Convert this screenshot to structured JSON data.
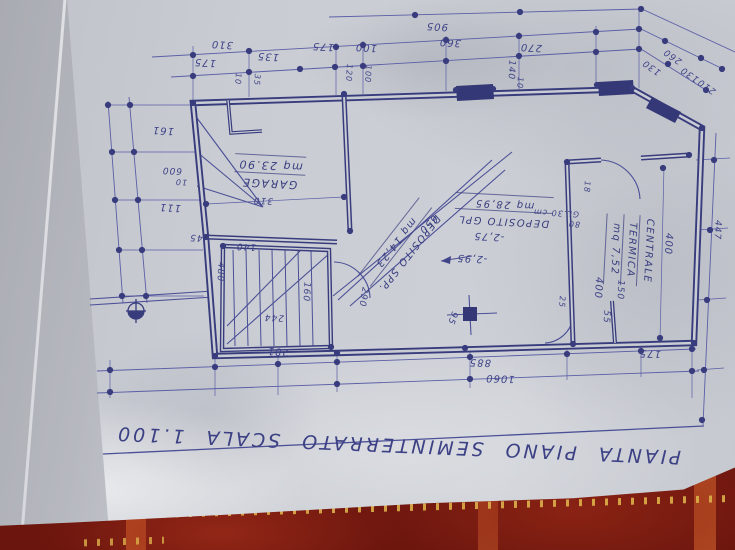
{
  "plan": {
    "title": "PIANTA PIANO SEMINTERRATO SCALA 1.100",
    "rooms": [
      {
        "lines": [
          "GARAGE",
          "mq 23.90"
        ],
        "x": 270,
        "y": 173,
        "r": 183,
        "s": 11
      },
      {
        "lines": [
          "DEPOSITO SPP.",
          "mq 14,23"
        ],
        "x": 401,
        "y": 247,
        "r": 128,
        "s": 10
      },
      {
        "lines": [
          "DEPOSITO GPL",
          "mq 28,95"
        ],
        "x": 504,
        "y": 211,
        "r": 183,
        "s": 10
      },
      {
        "lines": [
          "CENTRALE",
          "TERMICA",
          "mq 7,52"
        ],
        "x": 630,
        "y": 250,
        "r": 93,
        "s": 10
      }
    ],
    "annotations": [
      {
        "t": "905",
        "x": 437,
        "y": 26,
        "r": 183
      },
      {
        "t": "310",
        "x": 222,
        "y": 44,
        "r": 183
      },
      {
        "t": "175",
        "x": 205,
        "y": 62,
        "r": 183
      },
      {
        "t": "135",
        "x": 268,
        "y": 56,
        "r": 183
      },
      {
        "t": "175",
        "x": 323,
        "y": 46,
        "r": 183
      },
      {
        "t": "100",
        "x": 366,
        "y": 47,
        "r": 183
      },
      {
        "t": "360",
        "x": 450,
        "y": 42,
        "r": 183
      },
      {
        "t": "270",
        "x": 531,
        "y": 47,
        "r": 183
      },
      {
        "t": "140",
        "x": 511,
        "y": 70,
        "r": 93,
        "s": 9
      },
      {
        "t": "10",
        "x": 520,
        "y": 83,
        "r": 93,
        "s": 8
      },
      {
        "t": "10",
        "x": 238,
        "y": 79,
        "r": 93,
        "s": 8
      },
      {
        "t": "35",
        "x": 257,
        "y": 80,
        "r": 93,
        "s": 8
      },
      {
        "t": "120",
        "x": 349,
        "y": 73,
        "r": 93,
        "s": 8
      },
      {
        "t": "100",
        "x": 368,
        "y": 74,
        "r": 93,
        "s": 8
      },
      {
        "t": "130",
        "x": 652,
        "y": 67,
        "r": 215,
        "s": 9
      },
      {
        "t": "260",
        "x": 673,
        "y": 56,
        "r": 215,
        "s": 9
      },
      {
        "t": "130",
        "x": 690,
        "y": 74,
        "r": 215,
        "s": 9
      },
      {
        "t": "210",
        "x": 707,
        "y": 86,
        "r": 215,
        "s": 9
      },
      {
        "t": "161",
        "x": 163,
        "y": 130,
        "r": 183
      },
      {
        "t": "600",
        "x": 172,
        "y": 170,
        "r": 183,
        "s": 9
      },
      {
        "t": "10",
        "x": 181,
        "y": 182,
        "r": 183,
        "s": 8
      },
      {
        "t": "111",
        "x": 170,
        "y": 207,
        "r": 183
      },
      {
        "t": "45",
        "x": 196,
        "y": 237,
        "r": 183,
        "s": 9
      },
      {
        "t": "140",
        "x": 246,
        "y": 246,
        "r": 183,
        "s": 9
      },
      {
        "t": "310",
        "x": 263,
        "y": 200,
        "r": 183,
        "s": 9
      },
      {
        "t": "480",
        "x": 220,
        "y": 272,
        "r": 93,
        "s": 9
      },
      {
        "t": "160",
        "x": 306,
        "y": 292,
        "r": 93,
        "s": 9
      },
      {
        "t": "290",
        "x": 363,
        "y": 297,
        "r": 100,
        "s": 9
      },
      {
        "t": "244",
        "x": 274,
        "y": 317,
        "r": 183,
        "s": 9
      },
      {
        "t": "281",
        "x": 278,
        "y": 351,
        "r": 183
      },
      {
        "t": "95",
        "x": 452,
        "y": 318,
        "r": 110,
        "s": 9
      },
      {
        "t": "650",
        "x": 428,
        "y": 224,
        "r": 135
      },
      {
        "t": "-2,75",
        "x": 489,
        "y": 236,
        "r": 183
      },
      {
        "t": "-2,95",
        "x": 472,
        "y": 258,
        "r": 183
      },
      {
        "t": "GL.30 cm",
        "x": 556,
        "y": 213,
        "r": 183,
        "s": 8
      },
      {
        "t": "80",
        "x": 574,
        "y": 224,
        "r": 183,
        "s": 8
      },
      {
        "t": "18",
        "x": 587,
        "y": 187,
        "r": 93,
        "s": 8
      },
      {
        "t": "25",
        "x": 562,
        "y": 302,
        "r": 93,
        "s": 8
      },
      {
        "t": "55",
        "x": 606,
        "y": 317,
        "r": 93,
        "s": 9
      },
      {
        "t": "150",
        "x": 620,
        "y": 290,
        "r": 93,
        "s": 9
      },
      {
        "t": "400",
        "x": 668,
        "y": 244,
        "r": 93
      },
      {
        "t": "400",
        "x": 598,
        "y": 288,
        "r": 93
      },
      {
        "t": "447",
        "x": 717,
        "y": 230,
        "r": 93,
        "s": 9
      },
      {
        "t": "175",
        "x": 650,
        "y": 353,
        "r": 182
      },
      {
        "t": "885",
        "x": 480,
        "y": 362,
        "r": 182
      },
      {
        "t": "1060",
        "x": 500,
        "y": 378,
        "r": 182
      }
    ]
  },
  "colors": {
    "ink": "#383c7d",
    "ink_light": "#5b5ea6",
    "paper": "#c9ccd3",
    "paper_fold": "#b0b2b8",
    "fabric": "#701710",
    "fabric_stripe": "#bf5526",
    "stitch": "#ddb04a"
  }
}
